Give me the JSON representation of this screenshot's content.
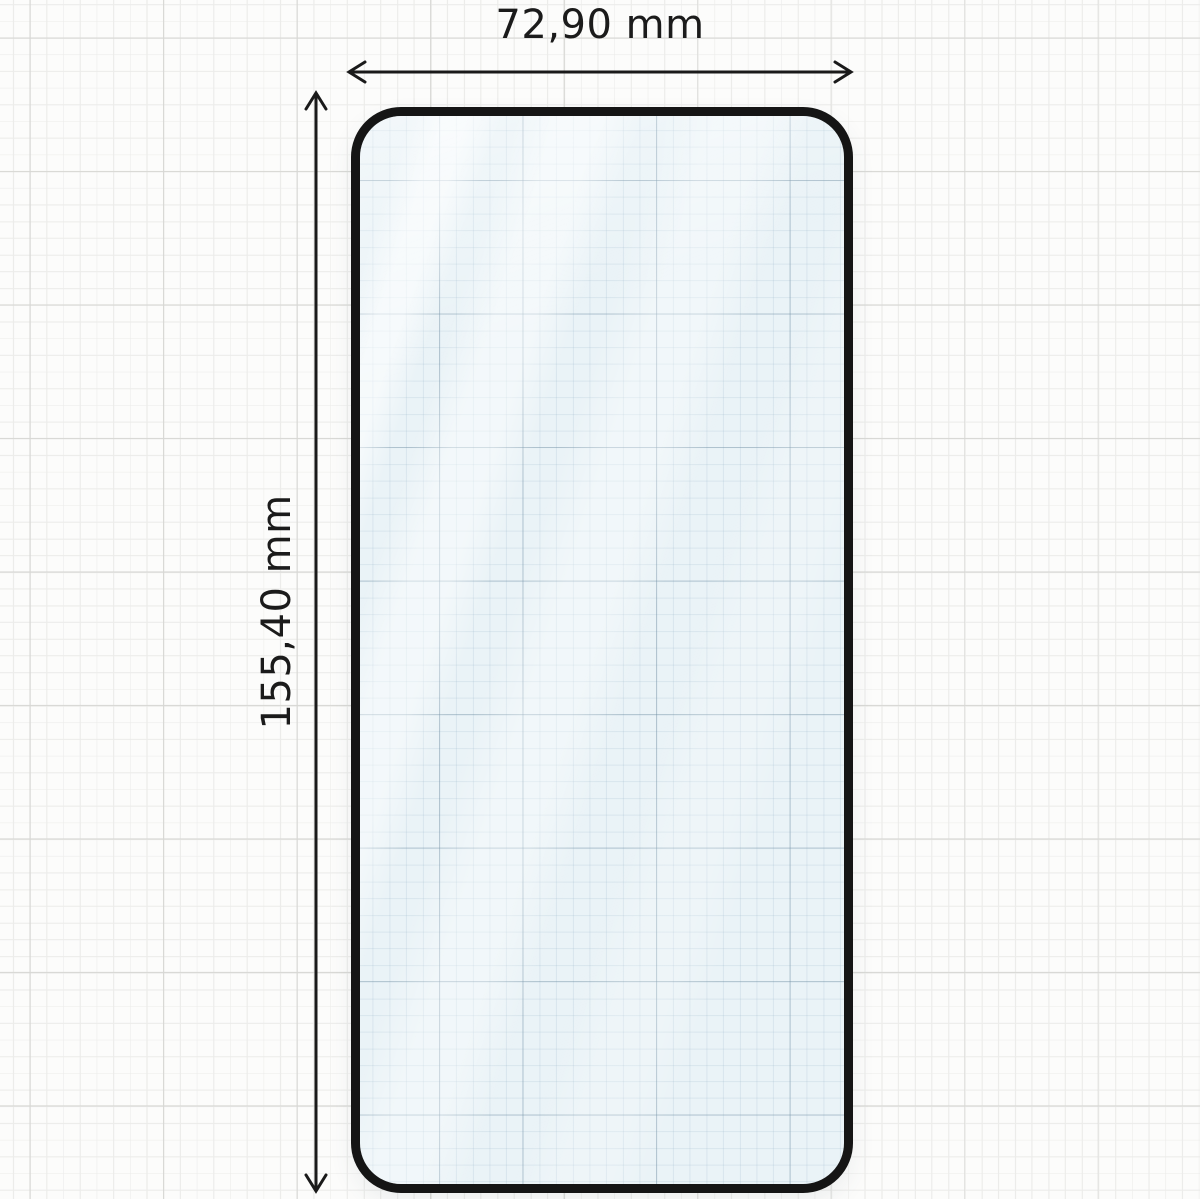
{
  "diagram": {
    "type": "screen-protector-dimension-drawing",
    "object": "tempered-glass-screen-protector",
    "width_label": "72,90 mm",
    "height_label": "155,40 mm"
  },
  "colors": {
    "outline": "#151515",
    "dimension_lines": "#1a1a1a",
    "glass_tint": "#eaf3f7",
    "paper_background": "#fcfcfb",
    "grid_minor": "#ececea",
    "grid_major": "#d7d7d4"
  }
}
